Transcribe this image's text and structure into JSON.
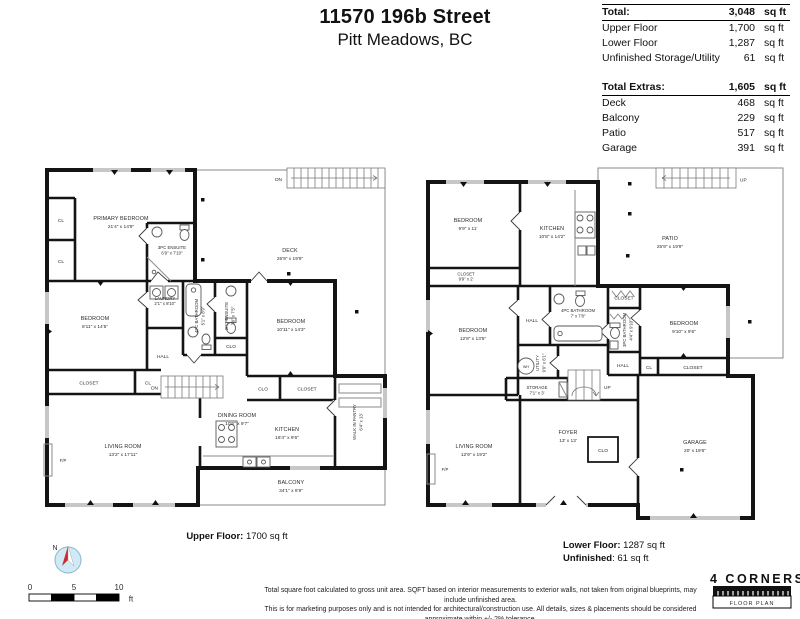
{
  "header": {
    "title": "11570 196b Street",
    "subtitle": "Pitt Meadows, BC"
  },
  "stats": {
    "total": {
      "label": "Total:",
      "value": "3,048",
      "unit": "sq ft"
    },
    "main_rows": [
      {
        "label": "Upper Floor",
        "value": "1,700",
        "unit": "sq ft"
      },
      {
        "label": "Lower Floor",
        "value": "1,287",
        "unit": "sq ft"
      },
      {
        "label": "Unfinished Storage/Utility",
        "value": "61",
        "unit": "sq ft"
      }
    ],
    "extras_total": {
      "label": "Total Extras:",
      "value": "1,605",
      "unit": "sq ft"
    },
    "extras_rows": [
      {
        "label": "Deck",
        "value": "468",
        "unit": "sq ft"
      },
      {
        "label": "Balcony",
        "value": "229",
        "unit": "sq ft"
      },
      {
        "label": "Patio",
        "value": "517",
        "unit": "sq ft"
      },
      {
        "label": "Garage",
        "value": "391",
        "unit": "sq ft"
      }
    ]
  },
  "upper": {
    "caption_label": "Upper Floor:",
    "caption_value": "1700 sq ft",
    "rooms": {
      "primary": {
        "name": "PRIMARY BEDROOM",
        "dims": "21'4\" x 14'9\""
      },
      "ensuite3": {
        "name": "3PC ENSUITE",
        "dims": "6'9\" x 7'10\""
      },
      "deck": {
        "name": "DECK",
        "dims": "25'9\" x 19'9\""
      },
      "bedroom_l": {
        "name": "BEDROOM",
        "dims": "8'11\" x 14'5\""
      },
      "laundry": {
        "name": "LAUNDRY",
        "dims": "2'1\" x 8'10\""
      },
      "bath4": {
        "name": "4PC BATHROOM",
        "dims": "5'1\" x 8'9\""
      },
      "ensuite2": {
        "name": "2PC ENSUITE",
        "dims": "7'9\" x 7'5\""
      },
      "bedroom_r": {
        "name": "BEDROOM",
        "dims": "10'11\" x 14'3\""
      },
      "living": {
        "name": "LIVING ROOM",
        "dims": "13'2\" x 17'11\""
      },
      "dining": {
        "name": "DINING ROOM",
        "dims": "10'6\" x 9'7\""
      },
      "kitchen": {
        "name": "KITCHEN",
        "dims": "16'4\" x 9'6\""
      },
      "pantry": {
        "name": "WALK IN PANTRY",
        "dims": "6'4\" x 13'"
      },
      "balcony": {
        "name": "BALCONY",
        "dims": "34'1\" x 6'9\""
      }
    },
    "labels": {
      "hall": "HALL",
      "closet": "CLOSET",
      "cl": "CL",
      "clo": "CLO",
      "dn": "DN",
      "fp": "F/P"
    }
  },
  "lower": {
    "caption1_label": "Lower Floor:",
    "caption1_value": "1287 sq ft",
    "caption2_label": "Unfinished",
    "caption2_value": ": 61 sq ft",
    "rooms": {
      "bedroom_tl": {
        "name": "BEDROOM",
        "dims": "9'9\" x 11'"
      },
      "kitchen": {
        "name": "KITCHEN",
        "dims": "10'8\" x 14'2\""
      },
      "closet_tl": {
        "name": "CLOSET",
        "dims": "9'9\" x 2'"
      },
      "patio": {
        "name": "PATIO",
        "dims": "25'9\" x 19'9\""
      },
      "bedroom_ml": {
        "name": "BEDROOM",
        "dims": "12'8\" x 13'5\""
      },
      "bath4": {
        "name": "4PC BATHROOM",
        "dims": "7' x 7'8\""
      },
      "utility": {
        "name": "UTILITY",
        "dims": "9'9\" x 6'1\""
      },
      "storage": {
        "name": "STORAGE",
        "dims": "7'1\" x 3'"
      },
      "bath3": {
        "name": "3PC BATHROOM",
        "dims": "4'4\" x 9'10\""
      },
      "bedroom_r": {
        "name": "BEDROOM",
        "dims": "9'10\" x 9'6\""
      },
      "living": {
        "name": "LIVING ROOM",
        "dims": "12'9\" x 19'2\""
      },
      "foyer": {
        "name": "FOYER",
        "dims": "13' x 13'"
      },
      "garage": {
        "name": "GARAGE",
        "dims": "20' x 19'6\""
      }
    },
    "labels": {
      "hall": "HALL",
      "closet": "CLOSET",
      "cl": "CL",
      "clo": "CLO",
      "up": "UP",
      "fp": "F/P",
      "wh": "WH"
    }
  },
  "footer": {
    "north_letter": "N",
    "scale": {
      "t0": "0",
      "t5": "5",
      "t10": "10",
      "unit": "ft"
    },
    "disclaimer1": "Total square foot calculated to gross unit area. SQFT based on interior measurements to exterior walls, not taken from original blueprints, may include unfinished area.",
    "disclaimer2": "This is for marketing purposes only and is not intended for architectural/construction use.  All details, sizes & placements should be considered approximate within +/- 2%  tolerance.",
    "logo_line1": "4 CORNERS",
    "logo_line2": "FLOOR PLAN"
  }
}
